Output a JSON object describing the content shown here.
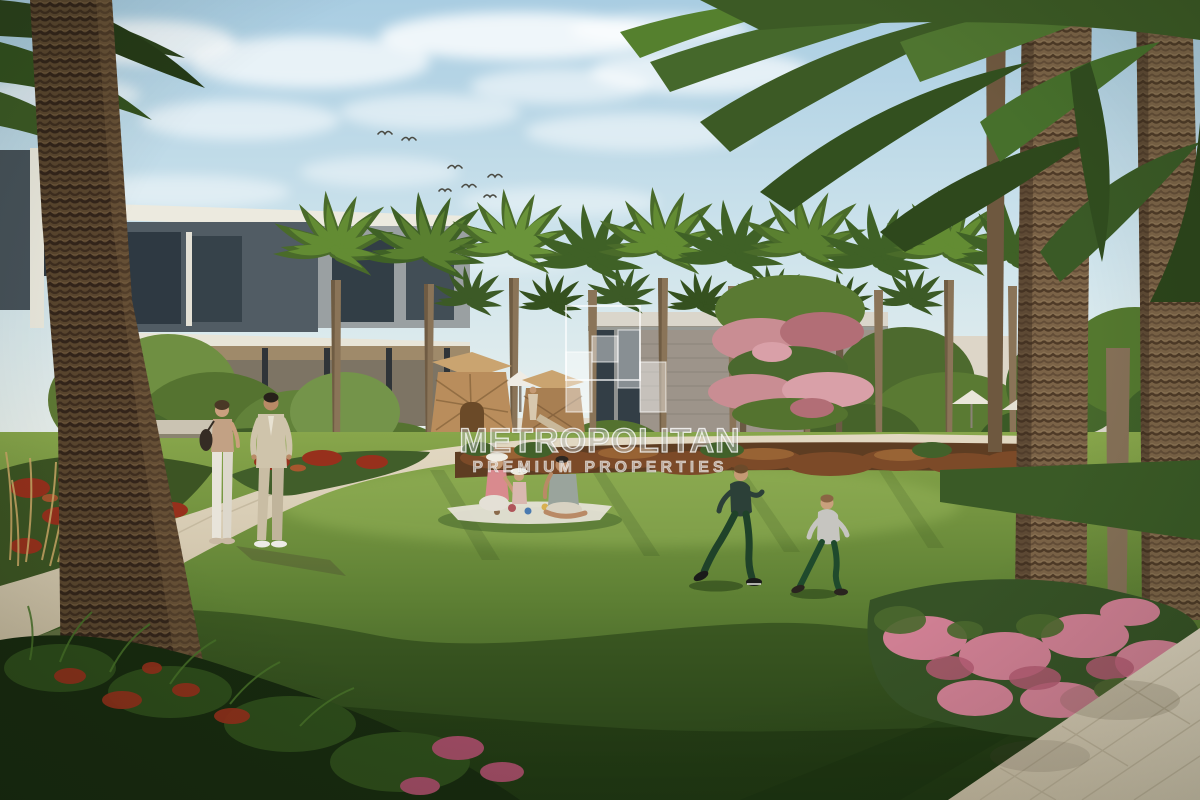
{
  "meta": {
    "title": "Landscaped community park rendering",
    "description": "Sunny architectural rendering of a residential community park: a curved paved path with a couple walking, a family picnicking on a lawn, two boys running, rows of date palms, modern flat-roof townhouses and a pavilion in the background, pink flowering shrubs and a paved walkway in the foreground corner, birds flying in a lightly clouded blue sky."
  },
  "watermark": {
    "brand": "METROPOLITAN",
    "tagline": "PREMIUM PROPERTIES"
  },
  "scene": {
    "setting": "residential community park, daytime",
    "elements": [
      "blue sky with scattered clouds",
      "flock of birds",
      "modern townhouses on the left",
      "community pavilion building",
      "wooden playground huts",
      "row of date palm trees",
      "pink flowering tree",
      "russet and green hedges",
      "central green lawn",
      "curved walking path",
      "couple walking on path",
      "family picnic on a blanket",
      "two boys running on the grass",
      "tall palm trunks on the right",
      "pink flower shrubs",
      "paved walkway in bottom-right corner",
      "semi-transparent Metropolitan Premium Properties watermark"
    ]
  },
  "colors": {
    "sky_top": "#a9cde2",
    "sky_mid": "#cde3ec",
    "sky_horizon": "#eaf1ee",
    "cloud_white": "#ffffff",
    "lawn_light": "#88a64b",
    "lawn_mid": "#5e8034",
    "lawn_dark": "#2c471c",
    "path_light": "#e3d9c3",
    "path_dark": "#c7ba9f",
    "pavement_light": "#ddd3bf",
    "pavement_dark": "#c4b8a0",
    "trunk_brown": "#7b6347",
    "trunk_dark": "#59452e",
    "foliage_dark": "#2e481d",
    "foliage_mid": "#4a6b2a",
    "foliage_light": "#7da23f",
    "building_white": "#eceadf",
    "building_gray": "#515c64",
    "glass_dark": "#2f3a42",
    "hedge_russet": "#5e3d22",
    "flower_red": "#97301c",
    "flower_pink": "#cf7f93",
    "skin": "#c59a74",
    "suit_beige": "#cfc4ab",
    "watermark_white": "#ffffff"
  }
}
